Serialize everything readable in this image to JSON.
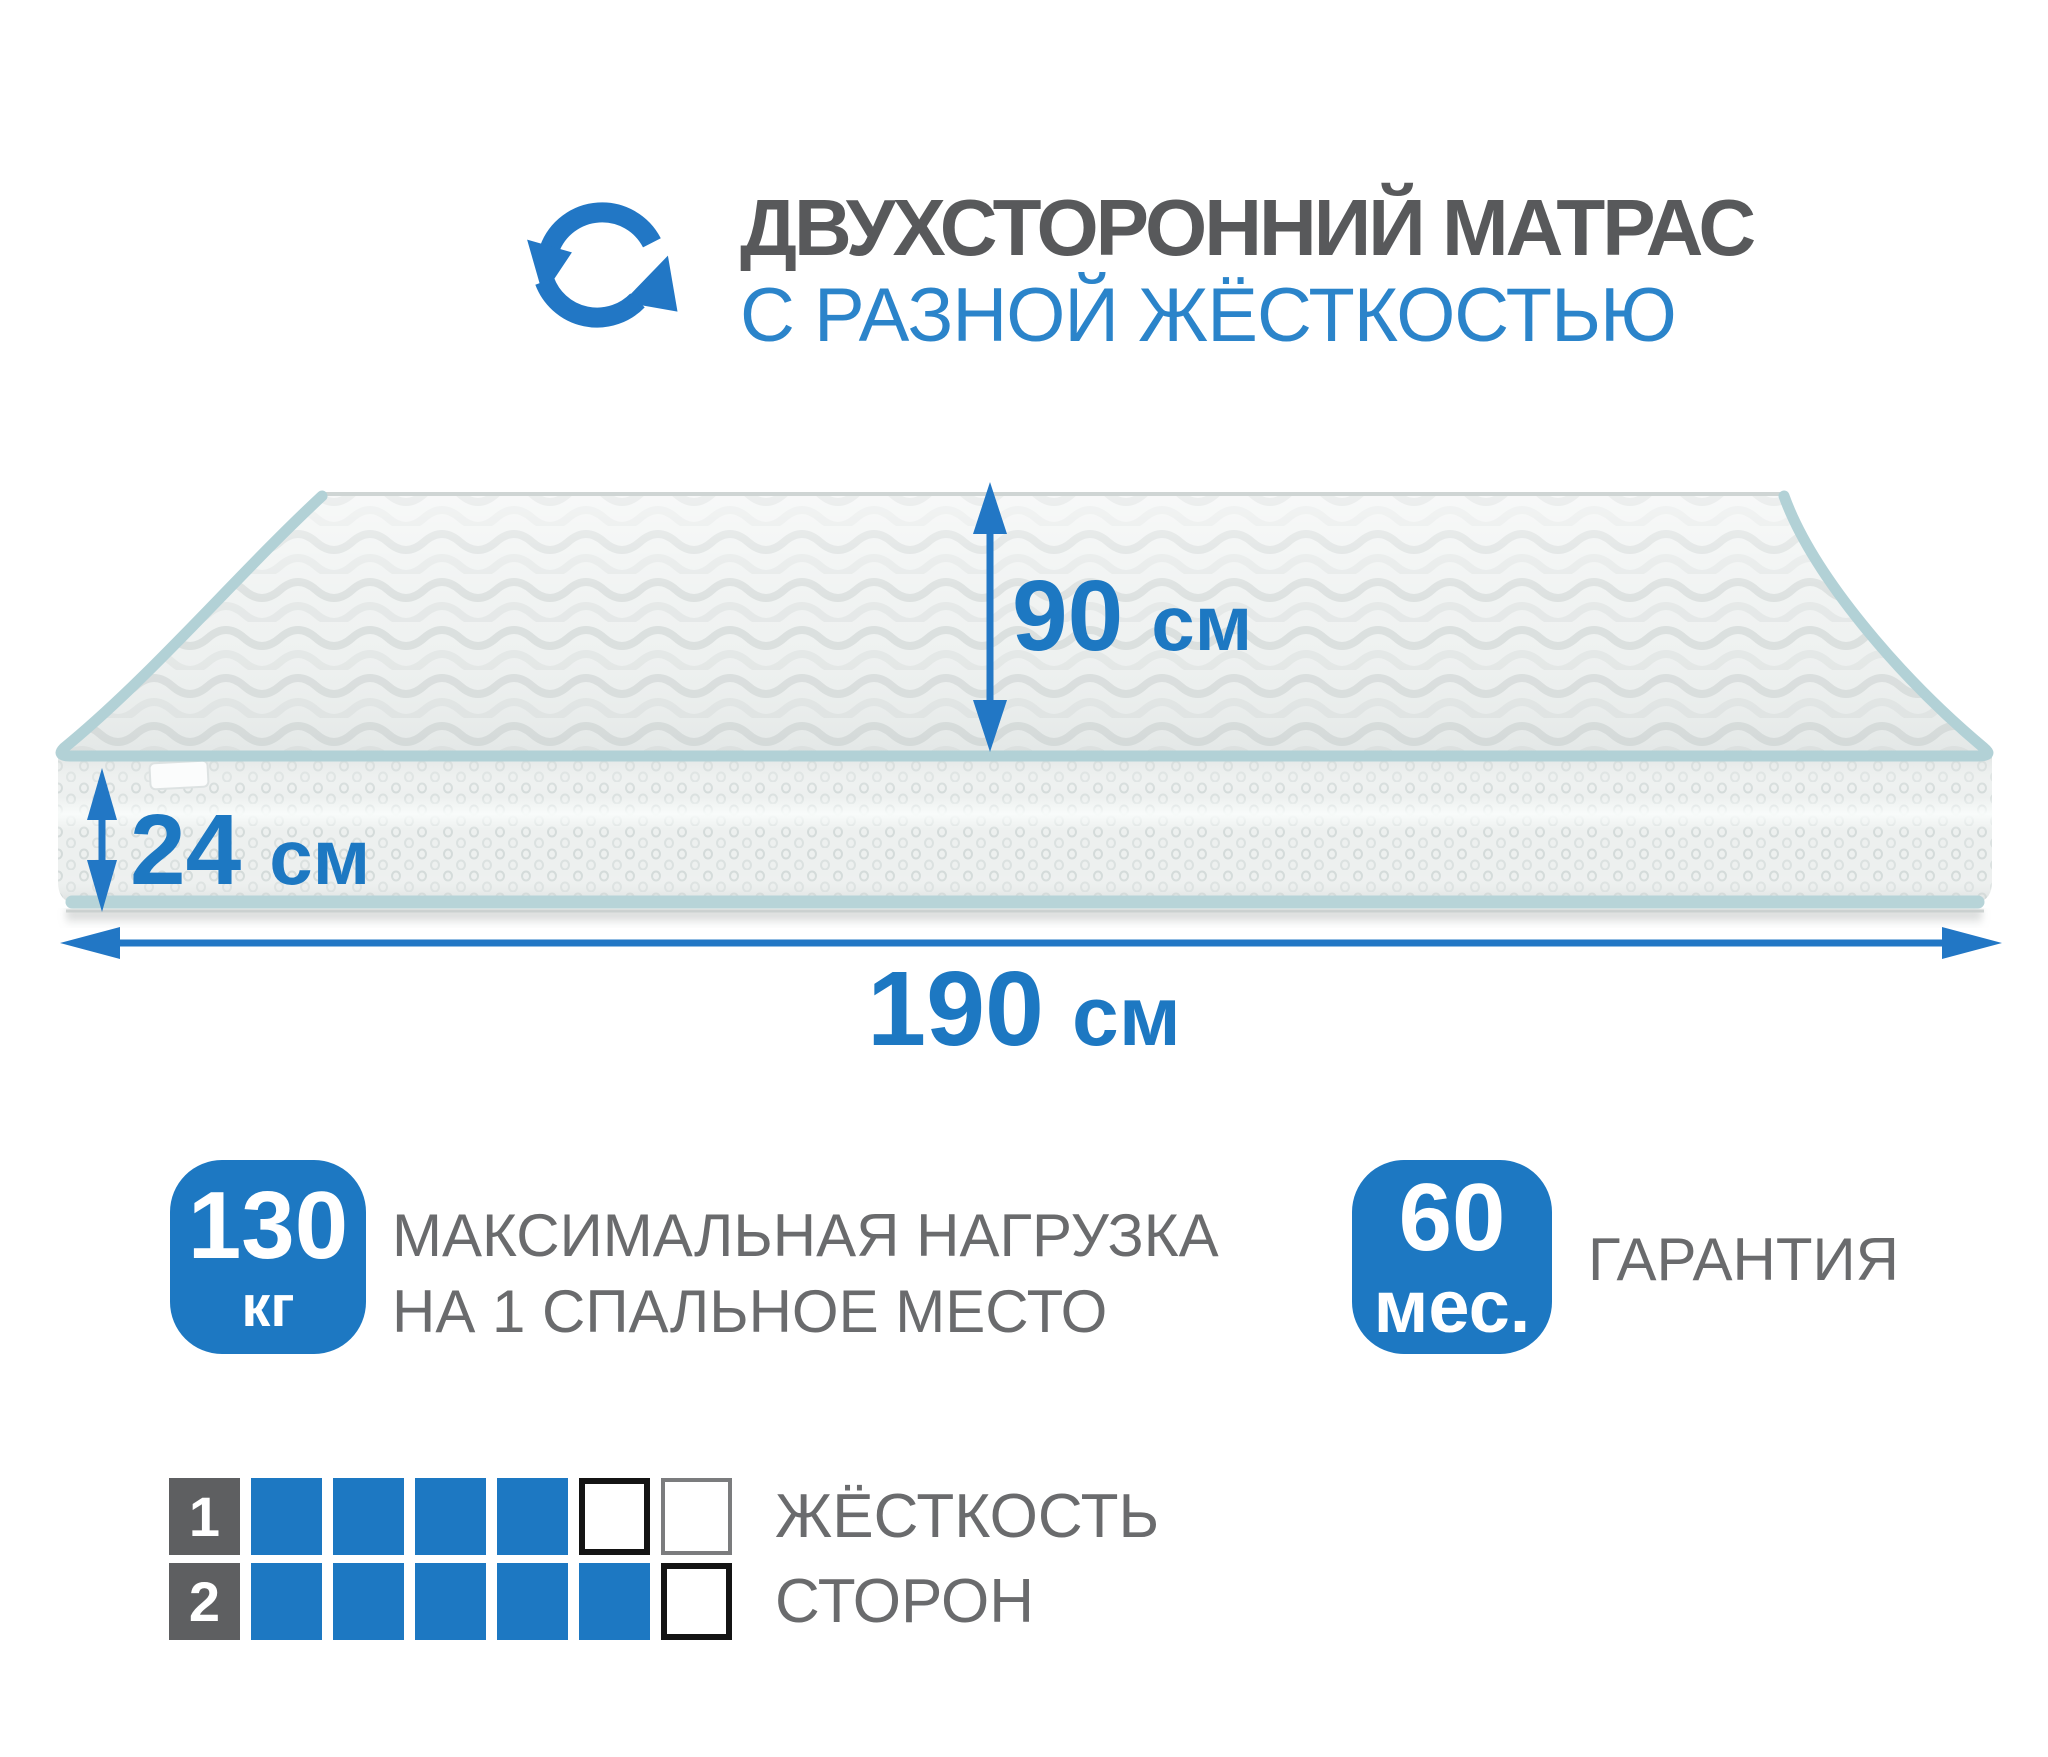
{
  "colors": {
    "accent_blue": "#1d78c2",
    "subtitle_blue": "#2b84ca",
    "title_gray": "#58595b",
    "text_gray": "#6a6b6d",
    "side_square_gray": "#5e5f61",
    "mattress_piping": "#b2d1d6"
  },
  "icons": {
    "header": "rotate-arrows-icon"
  },
  "header": {
    "title": "ДВУХСТОРОННИЙ МАТРАС",
    "subtitle": "С РАЗНОЙ ЖЁСТКОСТЬЮ"
  },
  "dimensions": {
    "depth": {
      "value": "90",
      "unit": "см"
    },
    "height": {
      "value": "24",
      "unit": "см"
    },
    "width": {
      "value": "190",
      "unit": "см"
    }
  },
  "features": {
    "max_load": {
      "value": "130",
      "unit": "кг",
      "label_line1": "МАКСИМАЛЬНАЯ НАГРУЗКА",
      "label_line2": "НА 1 СПАЛЬНОЕ МЕСТО"
    },
    "warranty": {
      "value": "60",
      "unit": "мес.",
      "label": "ГАРАНТИЯ"
    }
  },
  "hardness_scale": {
    "label_line1": "ЖЁСТКОСТЬ",
    "label_line2": "СТОРОН",
    "cells_total": 6,
    "rows": [
      {
        "side": "1",
        "filled": 4,
        "outline_dark": 1,
        "outline_light": 1
      },
      {
        "side": "2",
        "filled": 5,
        "outline_dark": 1,
        "outline_light": 0
      }
    ]
  }
}
